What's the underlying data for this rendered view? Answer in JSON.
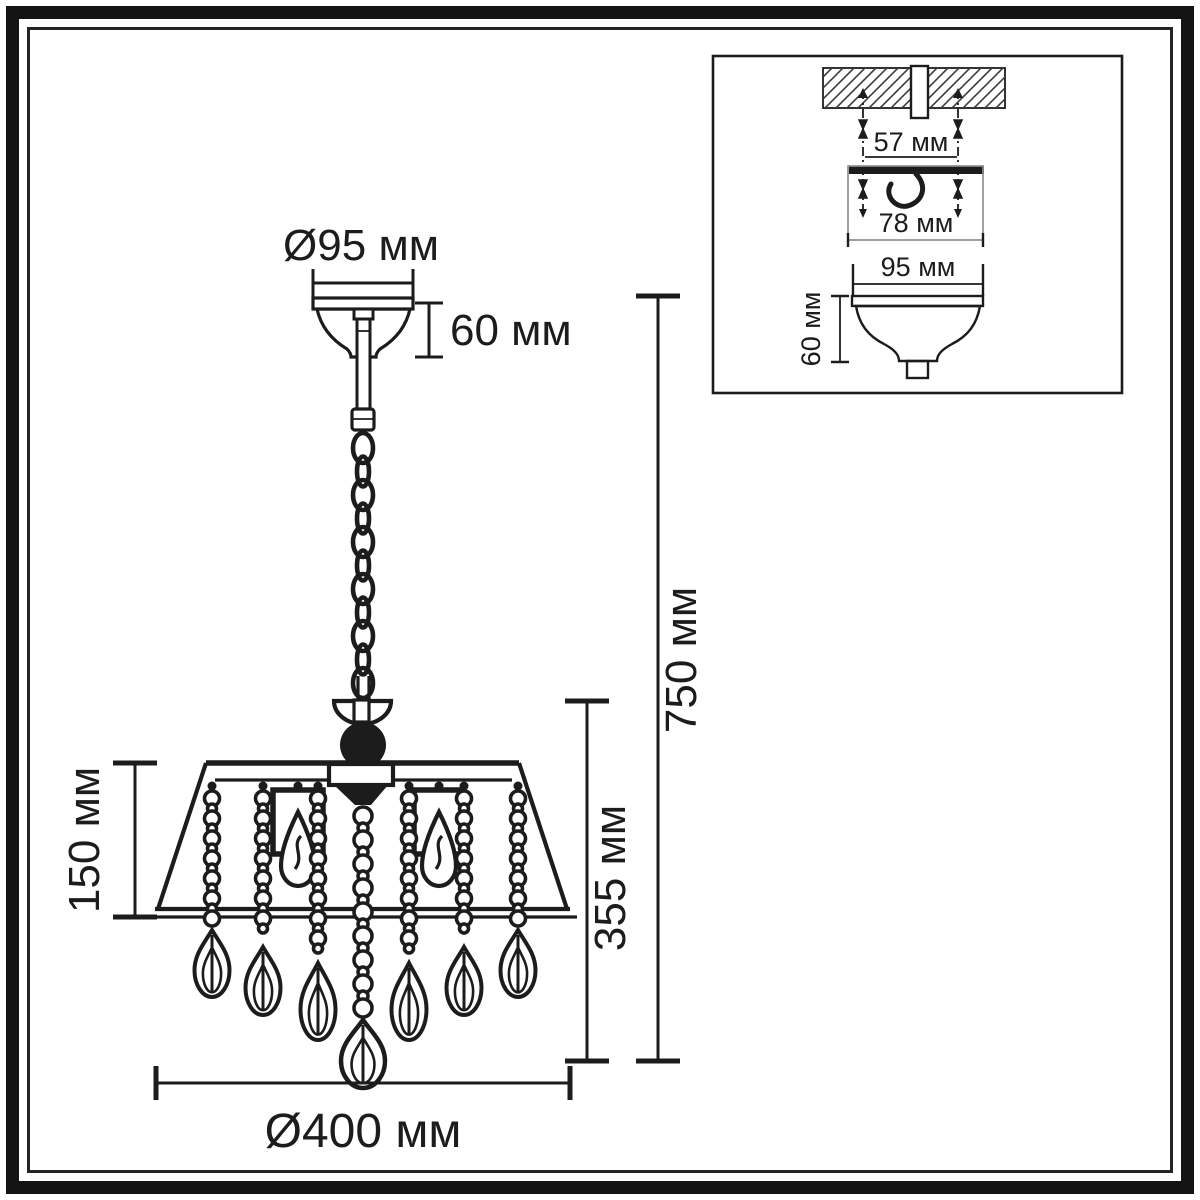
{
  "drawing_type": "chandelier dimension diagram",
  "units": "мм",
  "main_view": {
    "canopy_diameter_label": "Ø95 мм",
    "canopy_height_label": "60 мм",
    "overall_height_label": "750 мм",
    "body_height_label": "355 мм",
    "shade_height_label": "150 мм",
    "body_diameter_label": "Ø400 мм"
  },
  "mounting_detail": {
    "screw_spacing_label": "57 мм",
    "bracket_width_label": "78 мм",
    "canopy_diameter_label": "95 мм",
    "canopy_height_label": "60 мм"
  },
  "colors": {
    "ink": "#1c1c1c",
    "background": "#ffffff",
    "frame": "#141414",
    "light_line": "#8f8f8f"
  }
}
